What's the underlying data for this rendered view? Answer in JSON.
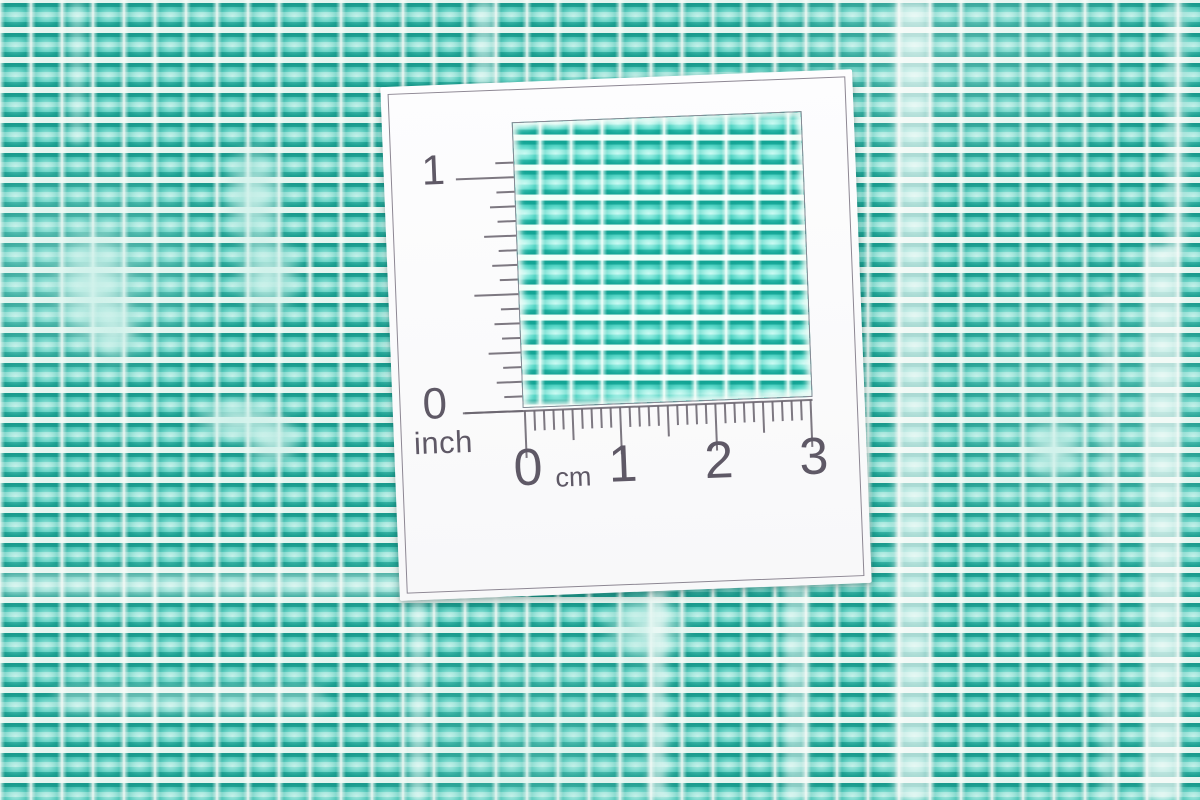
{
  "card": {
    "inch_ruler": {
      "label_one": "1",
      "label_zero": "0",
      "unit": "inch",
      "subdivisions_per_unit": 16,
      "units_shown": 1,
      "extra_ticks_above": 1
    },
    "cm_ruler": {
      "labels": [
        "0",
        "1",
        "2",
        "3"
      ],
      "unit": "cm",
      "subdivisions_per_unit": 10,
      "units_shown": 3
    }
  },
  "colors": {
    "fabric_teal": "#2bb3a4",
    "fabric_teal_dark": "#17998b",
    "fabric_aqua_light": "#a7e7de",
    "fabric_white": "#f4faf3",
    "card_white": "#fcfcfd",
    "ruler_ink": "#6b6570",
    "card_border": "#8d8793"
  }
}
